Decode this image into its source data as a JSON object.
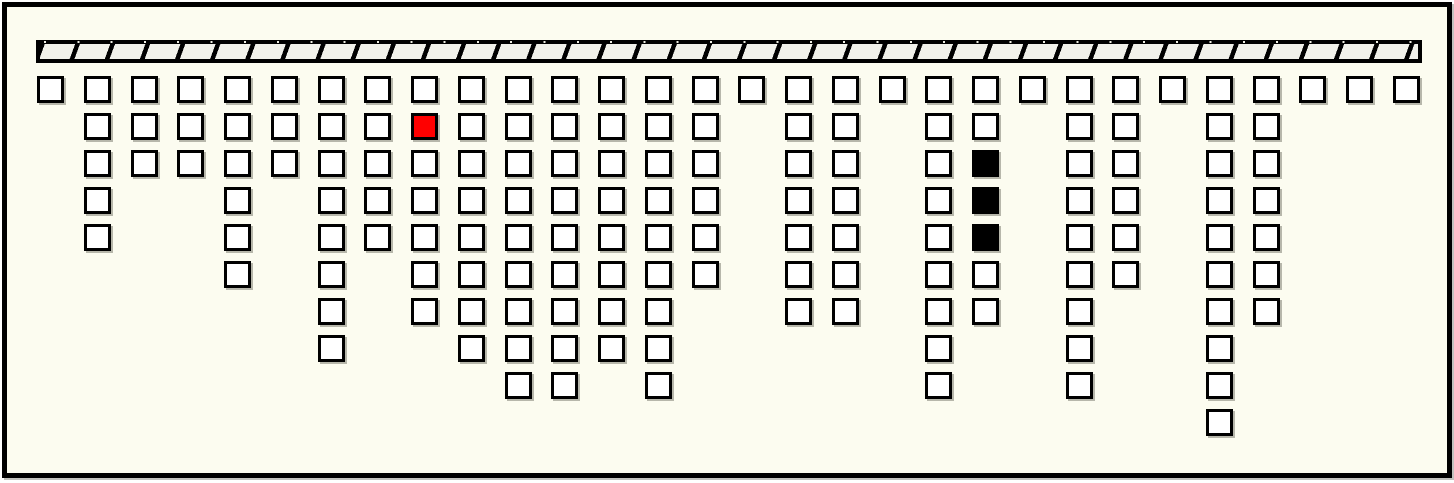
{
  "window": {
    "outer_background": "#ffffff"
  },
  "canvas": {
    "background": "#fcfcf0",
    "border_color": "#000000"
  },
  "ceiling_bar": {
    "bar_color": "#000000",
    "hatch_fill_color": "#f1f1ea",
    "hatch_stripe_color": "#000000"
  },
  "cell_colors": {
    "white": "#ffffff",
    "red": "#ff0000",
    "black": "#000000",
    "border": "#000000",
    "shadow": "#7d7d73"
  },
  "diagram": {
    "type": "bucket-chain-grid",
    "bucket_count": 30,
    "total_cells": 159,
    "red_cell": {
      "column": 9,
      "row": 2
    },
    "black_cells": [
      {
        "column": 21,
        "row": 3
      },
      {
        "column": 21,
        "row": 4
      },
      {
        "column": 21,
        "row": 5
      }
    ],
    "columns": [
      [
        "white"
      ],
      [
        "white",
        "white",
        "white",
        "white",
        "white"
      ],
      [
        "white",
        "white",
        "white"
      ],
      [
        "white",
        "white",
        "white"
      ],
      [
        "white",
        "white",
        "white",
        "white",
        "white",
        "white"
      ],
      [
        "white",
        "white",
        "white"
      ],
      [
        "white",
        "white",
        "white",
        "white",
        "white",
        "white",
        "white",
        "white"
      ],
      [
        "white",
        "white",
        "white",
        "white",
        "white"
      ],
      [
        "white",
        "red",
        "white",
        "white",
        "white",
        "white",
        "white"
      ],
      [
        "white",
        "white",
        "white",
        "white",
        "white",
        "white",
        "white",
        "white"
      ],
      [
        "white",
        "white",
        "white",
        "white",
        "white",
        "white",
        "white",
        "white",
        "white"
      ],
      [
        "white",
        "white",
        "white",
        "white",
        "white",
        "white",
        "white",
        "white",
        "white"
      ],
      [
        "white",
        "white",
        "white",
        "white",
        "white",
        "white",
        "white",
        "white"
      ],
      [
        "white",
        "white",
        "white",
        "white",
        "white",
        "white",
        "white",
        "white",
        "white"
      ],
      [
        "white",
        "white",
        "white",
        "white",
        "white",
        "white"
      ],
      [
        "white"
      ],
      [
        "white",
        "white",
        "white",
        "white",
        "white",
        "white",
        "white"
      ],
      [
        "white",
        "white",
        "white",
        "white",
        "white",
        "white",
        "white"
      ],
      [
        "white"
      ],
      [
        "white",
        "white",
        "white",
        "white",
        "white",
        "white",
        "white",
        "white",
        "white"
      ],
      [
        "white",
        "white",
        "black",
        "black",
        "black",
        "white",
        "white"
      ],
      [
        "white"
      ],
      [
        "white",
        "white",
        "white",
        "white",
        "white",
        "white",
        "white",
        "white",
        "white"
      ],
      [
        "white",
        "white",
        "white",
        "white",
        "white",
        "white"
      ],
      [
        "white"
      ],
      [
        "white",
        "white",
        "white",
        "white",
        "white",
        "white",
        "white",
        "white",
        "white",
        "white"
      ],
      [
        "white",
        "white",
        "white",
        "white",
        "white",
        "white",
        "white"
      ],
      [
        "white"
      ],
      [
        "white"
      ],
      [
        "white"
      ]
    ]
  }
}
